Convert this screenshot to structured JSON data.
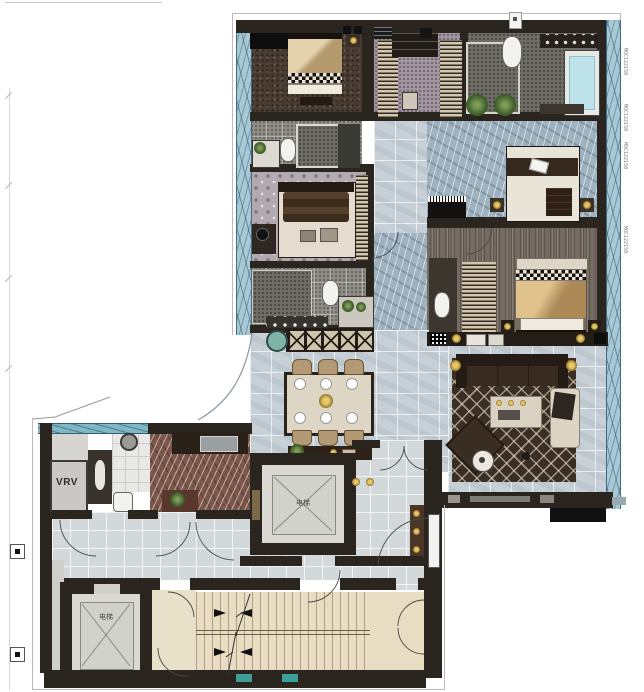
{
  "labels": {
    "vrv": "VRV",
    "elevator_a": "电梯",
    "elevator_b": "电梯"
  },
  "window_codes": [
    "MQC122150",
    "MQC122150",
    "MQC122150",
    "MQC122150"
  ],
  "colors": {
    "glass": "#a9c8d5",
    "glass_frame": "#3f6c80",
    "wall": "#2b2520",
    "tile_floor": "#c6d0d6",
    "marble_corridor": "#9fb2c0",
    "kitchen_marble": "#7a574a",
    "bedroom_carpet": "#4a3c32",
    "damask_carpet": "#b3aab1",
    "wood_floor": "#746a60",
    "living_rug": "#3a2e25",
    "stair_floor": "#e8ddc2",
    "lobby_floor": "#e9e0ca",
    "elevator_floor": "#d9d8d2",
    "bath_stone": "#8d8c85",
    "bed_tan": "#cdb289",
    "bed_gold": "#c9a86c",
    "tub_water": "#bfe3ea",
    "accent_gold": "#c9a24a",
    "teal_inset": "#3e9e98"
  }
}
